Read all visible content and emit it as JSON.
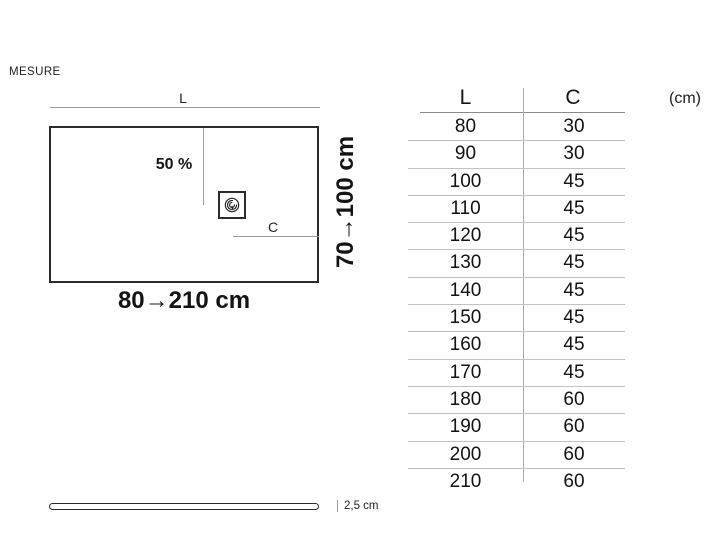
{
  "page": {
    "title_label": "MESURE"
  },
  "diagram": {
    "length_label": "L",
    "slope_label": "50 %",
    "drain_offset_label": "C",
    "width_range_label": "70→100 cm",
    "length_range_label": "80→210 cm"
  },
  "table": {
    "col_l_header": "L",
    "col_c_header": "C",
    "unit_label": "(cm)",
    "rows": [
      {
        "l": "80",
        "c": "30"
      },
      {
        "l": "90",
        "c": "30"
      },
      {
        "l": "100",
        "c": "45"
      },
      {
        "l": "110",
        "c": "45"
      },
      {
        "l": "120",
        "c": "45"
      },
      {
        "l": "130",
        "c": "45"
      },
      {
        "l": "140",
        "c": "45"
      },
      {
        "l": "150",
        "c": "45"
      },
      {
        "l": "160",
        "c": "45"
      },
      {
        "l": "170",
        "c": "45"
      },
      {
        "l": "180",
        "c": "60"
      },
      {
        "l": "190",
        "c": "60"
      },
      {
        "l": "200",
        "c": "60"
      },
      {
        "l": "210",
        "c": "60"
      }
    ]
  },
  "profile": {
    "thickness_label": "2,5 cm"
  },
  "icons": {
    "drain": "drain-spiral-icon"
  },
  "colors": {
    "outline": "#2b2b2b",
    "dimension_line": "#9a9a9a",
    "table_separator": "#c2c2c2",
    "table_header_rule": "#8a8a8a",
    "text": "#141414"
  }
}
